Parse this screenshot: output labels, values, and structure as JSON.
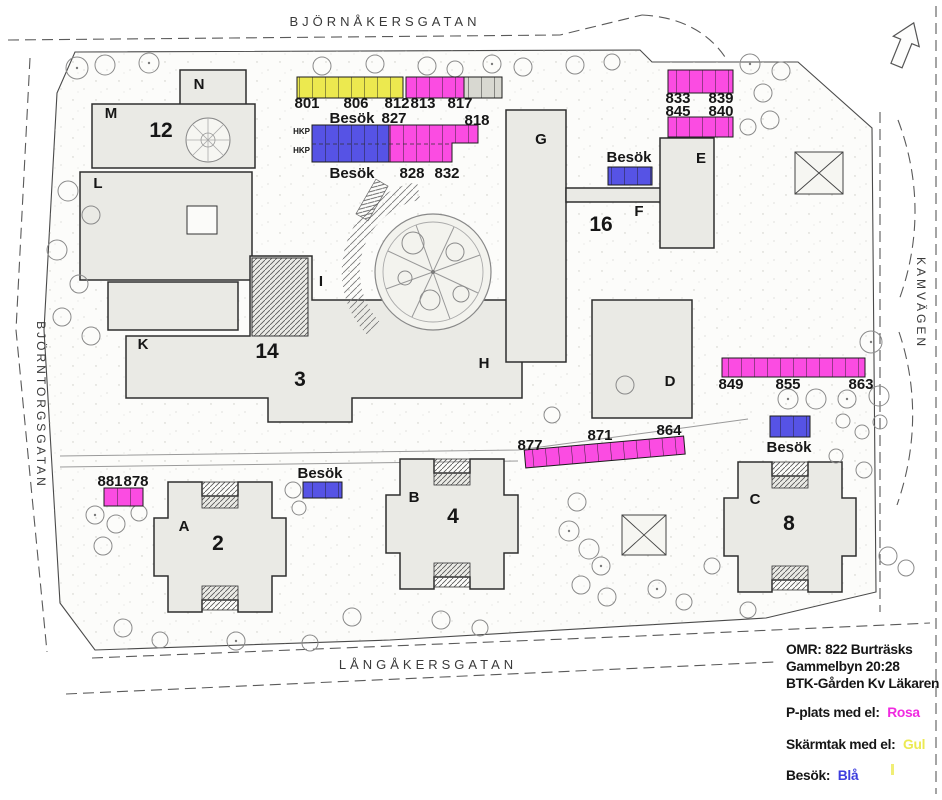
{
  "streets": {
    "top": "BJÖRNÅKERSGATAN",
    "left": "BJÖRNTORGSGATAN",
    "right": "KAMVÄGEN",
    "bottom": "LÅNGÅKERSGATAN"
  },
  "buildings": [
    "N",
    "M",
    "12",
    "L",
    "K",
    "14",
    "3",
    "I",
    "H",
    "G",
    "16",
    "F",
    "E",
    "D",
    "A",
    "2",
    "B",
    "4",
    "C",
    "8"
  ],
  "parking": {
    "north": {
      "carport": [
        "801",
        "806",
        "812"
      ],
      "el": [
        "813",
        "817"
      ],
      "besok_word": "Besök",
      "besok_num": "827",
      "end_num": "818",
      "hkp": "HKP",
      "row2_besok": "Besök",
      "row2": [
        "828",
        "832"
      ]
    },
    "northeast": {
      "row1": [
        "833",
        "839"
      ],
      "row2": [
        "845",
        "840"
      ],
      "besok": "Besök"
    },
    "east": {
      "row": [
        "849",
        "855",
        "863"
      ],
      "besok": "Besök"
    },
    "central": {
      "row": [
        "877",
        "871",
        "864"
      ]
    },
    "southwest": {
      "row": [
        "881",
        "878"
      ],
      "besok": "Besök"
    }
  },
  "legend": {
    "line1": "OMR: 822 Burträsks",
    "line2": "Gammelbyn 20:28",
    "line3": "BTK-Gården Kv Läkaren",
    "items": [
      {
        "label": "P-plats med el:",
        "value": "Rosa",
        "color": "#f02ae0"
      },
      {
        "label": "Skärmtak med el:",
        "value": "Gul",
        "color": "#ecea52"
      },
      {
        "label": "Besök:",
        "value": "Blå",
        "color": "#3d3dde"
      }
    ]
  },
  "colors": {
    "p_plats_el": "#fb4ce2",
    "skarmtak_el": "#ece94f",
    "besok": "#5653e5",
    "extra_stalls": "#d8d8d1",
    "building": "#eaeae5"
  },
  "icons": {
    "north_arrow": "north-arrow"
  }
}
